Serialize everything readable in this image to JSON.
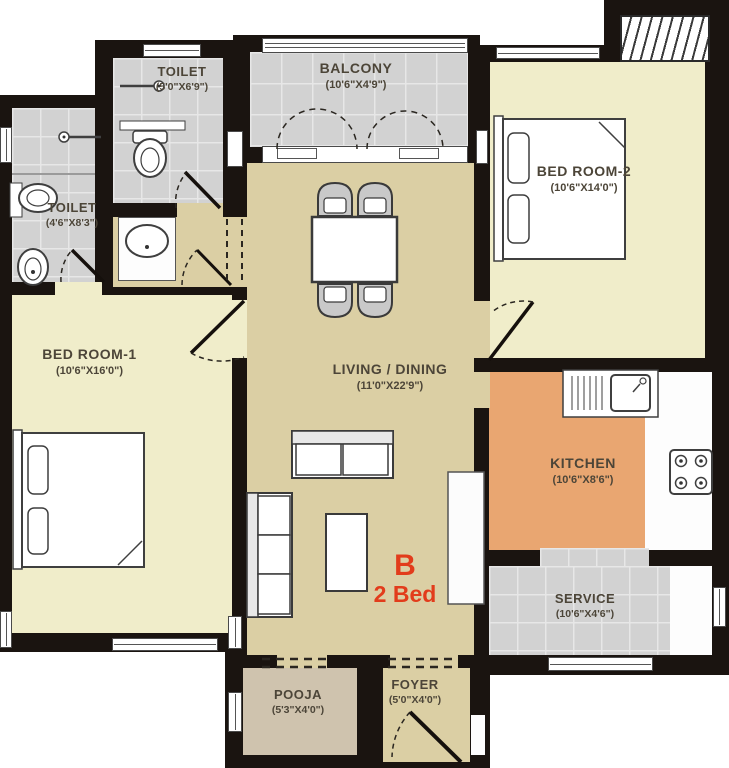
{
  "unit": {
    "block_label": "B",
    "type_label": "2 Bed"
  },
  "rooms": {
    "toilet1": {
      "name": "TOILET",
      "dims": "(5'0\"X6'9\")"
    },
    "toilet2": {
      "name": "TOILET",
      "dims": "(4'6\"X8'3\")"
    },
    "balcony": {
      "name": "BALCONY",
      "dims": "(10'6\"X4'9\")"
    },
    "bedroom2": {
      "name": "BED ROOM-2",
      "dims": "(10'6\"X14'0\")"
    },
    "bedroom1": {
      "name": "BED ROOM-1",
      "dims": "(10'6\"X16'0\")"
    },
    "living": {
      "name": "LIVING / DINING",
      "dims": "(11'0\"X22'9\")"
    },
    "kitchen": {
      "name": "KITCHEN",
      "dims": "(10'6\"X8'6\")"
    },
    "service": {
      "name": "SERVICE",
      "dims": "(10'6\"X4'6\")"
    },
    "pooja": {
      "name": "POOJA",
      "dims": "(5'3\"X4'0\")"
    },
    "foyer": {
      "name": "FOYER",
      "dims": "(5'0\"X4'0\")"
    }
  },
  "colors": {
    "wall": "#1a1410",
    "bedroom_floor": "#f0edca",
    "living_floor": "#dbcfa4",
    "tile_floor": "#d2d2d2",
    "kitchen_floor": "#e9a671",
    "pooja_floor": "#cfc3ae",
    "accent_text": "#e23c1b",
    "label_text": "#4c4538"
  }
}
